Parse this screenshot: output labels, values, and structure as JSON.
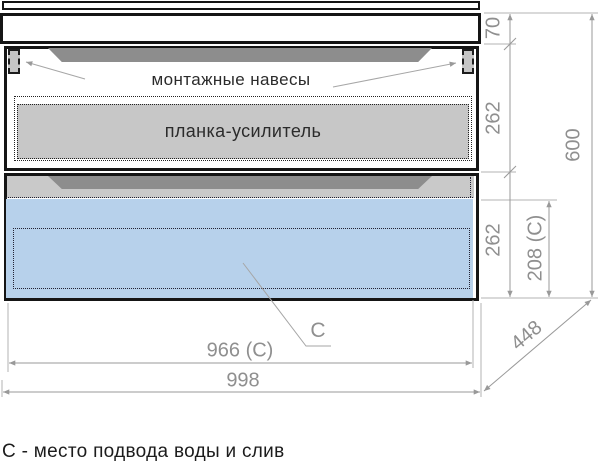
{
  "drawing": {
    "labels": {
      "mounting_hangers": "монтажные навесы",
      "reinforcement_bar": "планка-усилитель",
      "c_marker": "С"
    },
    "dimensions": {
      "top_section_height": "70",
      "drawer1_height": "262",
      "drawer2_height": "262",
      "c_zone_height": "208 (С)",
      "total_height": "600",
      "c_zone_width": "966 (С)",
      "total_width": "998",
      "depth": "448"
    },
    "caption": "С - место подвода воды и слив",
    "colors": {
      "line_black": "#151515",
      "dim_gray": "#8f8f8f",
      "panel_gray": "#c7c7c7",
      "handle_gray": "#8d8d8d",
      "c_zone_blue": "#b7d1eb"
    }
  }
}
